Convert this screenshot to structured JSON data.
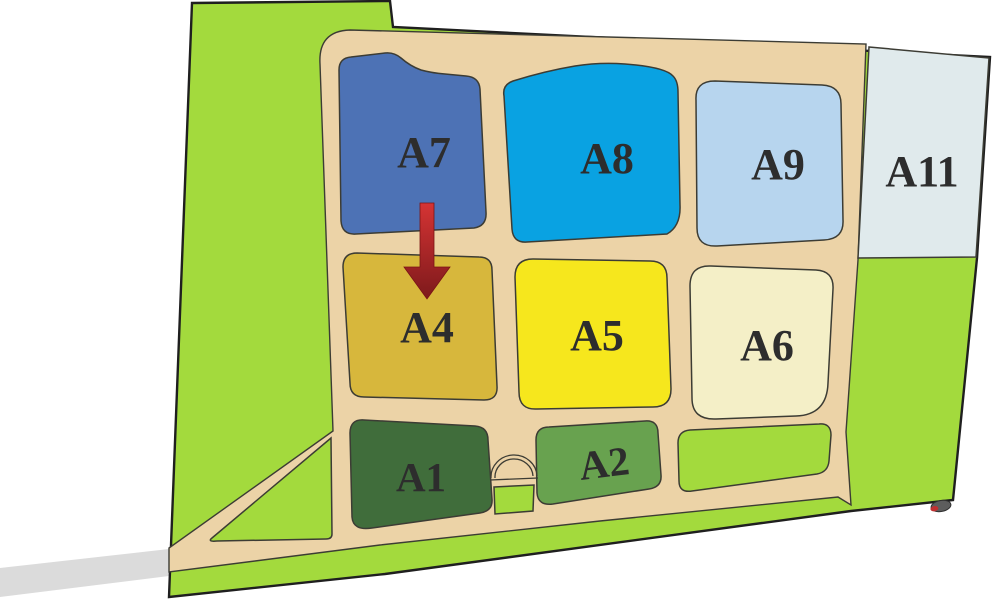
{
  "palette": {
    "background": "#ffffff",
    "terrain_green": "#a3da3d",
    "road_tan": "#ecd3a7",
    "plot_outline": "#3c3c34",
    "map_border": "#1f1f1f",
    "label_color": "#2d2d2d",
    "access_road_gray": "#dbdbdb",
    "arrow_red_top": "#da3535",
    "arrow_red_tip": "#7c191b",
    "marker_gray": "#5d5d5d",
    "marker_red": "#c03030"
  },
  "icons": {
    "arrow": "red-arrow-down-icon",
    "bridge": "arch-bridge-icon",
    "gate": "oval-gate-marker-icon"
  },
  "plots": {
    "a1": {
      "label": "A1",
      "color": "#406d3b"
    },
    "a2": {
      "label": "A2",
      "color": "#68a24f"
    },
    "a4": {
      "label": "A4",
      "color": "#d7b73c"
    },
    "a5": {
      "label": "A5",
      "color": "#f6e71d"
    },
    "a6": {
      "label": "A6",
      "color": "#f4efc7"
    },
    "a7": {
      "label": "A7",
      "color": "#4d72b5"
    },
    "a8": {
      "label": "A8",
      "color": "#09a2e2"
    },
    "a9": {
      "label": "A9",
      "color": "#b7d5ee"
    },
    "a11": {
      "label": "A11",
      "color": "#e0eaec"
    }
  }
}
